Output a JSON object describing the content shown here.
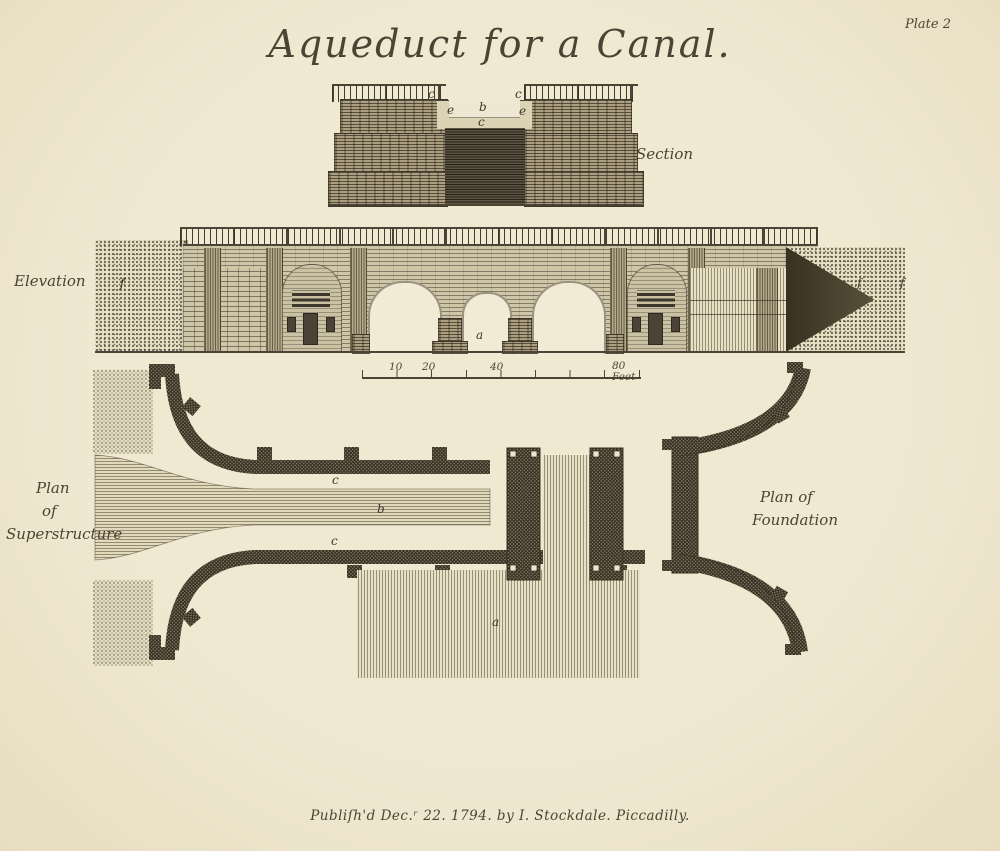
{
  "colors": {
    "paper": "#ece5cb",
    "ink": "#4a4336"
  },
  "plate": {
    "title": "Aqueduct for a Canal.",
    "plate_number": "Plate 2",
    "imprint": "Publiſh'd Dec.ʳ 22. 1794. by I. Stockdale. Piccadilly."
  },
  "section": {
    "label": "Section",
    "letters": {
      "c_left": "c",
      "c_right": "c",
      "e_left": "e",
      "b": "b",
      "e_right": "e",
      "c_bottom": "c"
    }
  },
  "elevation": {
    "label": "Elevation",
    "letters": {
      "f_left": "f",
      "a": "a",
      "f_right_inner": "f",
      "f_right_outer": "f"
    }
  },
  "scale_bar": {
    "tick_10": "10",
    "tick_20": "20",
    "tick_40": "40",
    "end_label": "80 Feet"
  },
  "plan_superstructure": {
    "label_lines": [
      "Plan",
      "of",
      "Superstructure"
    ],
    "letters": {
      "c_top": "c",
      "b": "b",
      "c_bottom": "c"
    }
  },
  "plan_foundation": {
    "label_lines": [
      "Plan of",
      "Foundation"
    ],
    "letters": {
      "a": "a"
    }
  }
}
